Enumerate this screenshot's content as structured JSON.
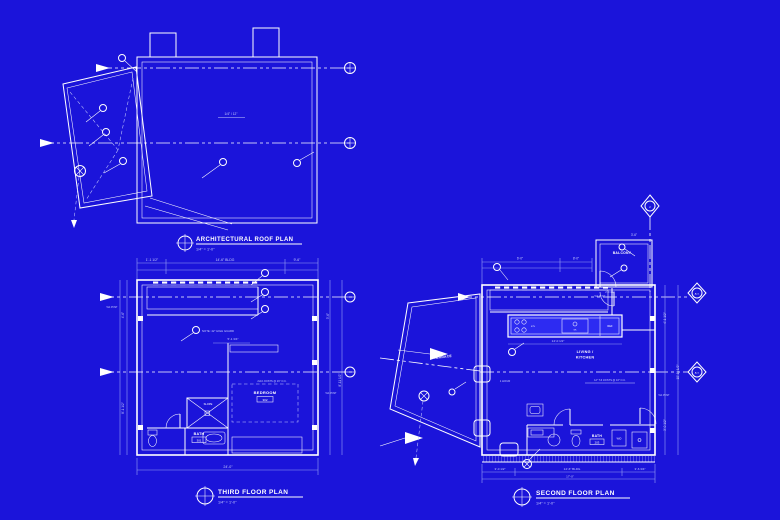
{
  "theme": {
    "bg": "#1b14da",
    "ink": "#ffffff",
    "dim": "#98a0f4",
    "soft": "#c7cdfd",
    "counter": "#2d2bf2"
  },
  "roof_plan": {
    "title": "ARCHITECTURAL ROOF PLAN",
    "scale": "1/4\" = 1'-0\"",
    "slope_note": "1/4\" / 12\""
  },
  "third_floor": {
    "title": "THIRD FLOOR PLAN",
    "scale": "1/4\" = 1'-0\"",
    "labels": {
      "bedroom": "BEDROOM",
      "bedroom_tag": "302",
      "bath": "BATH",
      "bath_tag": "301",
      "slope": "SLOPE"
    },
    "notes": {
      "guard": "NOTE: 42\" HIGH GUARD",
      "joists": "2x10 JOISTS @ 16\" O.C.",
      "post_left": "5x4 POST",
      "post_right": "5x4 POST"
    },
    "dims": {
      "top_left": "1'-1 1/2\"",
      "top_mid": "14'-6\" BLDG",
      "top_right": "9'-6\"",
      "bottom": "24'-0\"",
      "left_upper": "4'-6\"",
      "left_lower": "8'-1 1/2\"",
      "right_upper": "3'-6\"",
      "right_lower": "8'-11 1/2\"",
      "hall": "5'-1 3/4\""
    }
  },
  "second_floor": {
    "title": "SECOND FLOOR PLAN",
    "scale": "1/4\" = 1'-0\"",
    "labels": {
      "living": "LIVING /",
      "kitchen": "KITCHEN",
      "bath": "BATH",
      "bath_tag": "203",
      "balcony": "BALCONY",
      "terrace": "TERRACE",
      "washer": "W/D",
      "stove": "STV",
      "sink": "SK",
      "fridge": "REF"
    },
    "notes": {
      "hour": "1 HOUR",
      "joists": "12\" TJI JOISTS @ 16\" O.C.",
      "post_a": "5x4 POST",
      "post_b": "5x4 POST"
    },
    "dims": {
      "top_left": "6'-0\"",
      "top_mid": "8'-0\"",
      "top_right": "3'-6\"",
      "counter": "14'-0 1/2\"",
      "bottom_left": "3'-0 1/2\"",
      "bottom_mid": "14'-6\" BLDG",
      "bottom_right": "3'-6 3/4\"",
      "bottom_total": "17'-0\"",
      "right_upper": "4'-1 1/2\"",
      "right_mid": "10'-11 1/2\"",
      "right_lower": "3'-0 1/2\"",
      "balcony_dim": "2'-0 1/2\""
    },
    "section_ref_a": "A2.1",
    "section_ref_b": "A2.1",
    "grid_ref": "2"
  }
}
